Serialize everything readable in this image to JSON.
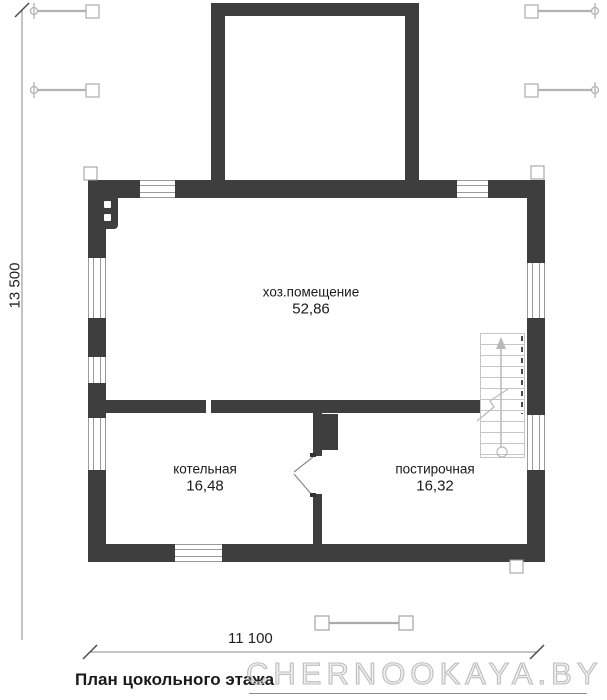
{
  "title": "План цокольного этажа",
  "watermark": "CHERNOOKAYA.BY",
  "dimensions": {
    "height": "13 500",
    "width": "11 100"
  },
  "rooms": [
    {
      "name": "хоз.помещение",
      "area": "52,86"
    },
    {
      "name": "котельная",
      "area": "16,48"
    },
    {
      "name": "постирочная",
      "area": "16,32"
    }
  ],
  "colors": {
    "wall": "#3e3e3e",
    "thin_line": "#8a8a8a",
    "light_symbol": "#b2b2b2",
    "stair": "#c6c6c6",
    "text": "#1a1a1a",
    "watermark": "#bdbdbd"
  },
  "symbols": {
    "tie_icon": "formwork-tie-icon",
    "pier_marker": "pier-marker",
    "stair_arrow": "stair-up-arrow-icon",
    "break_line": "stair-break-line",
    "door": "door-swing",
    "dim_tick": "dimension-tick"
  }
}
